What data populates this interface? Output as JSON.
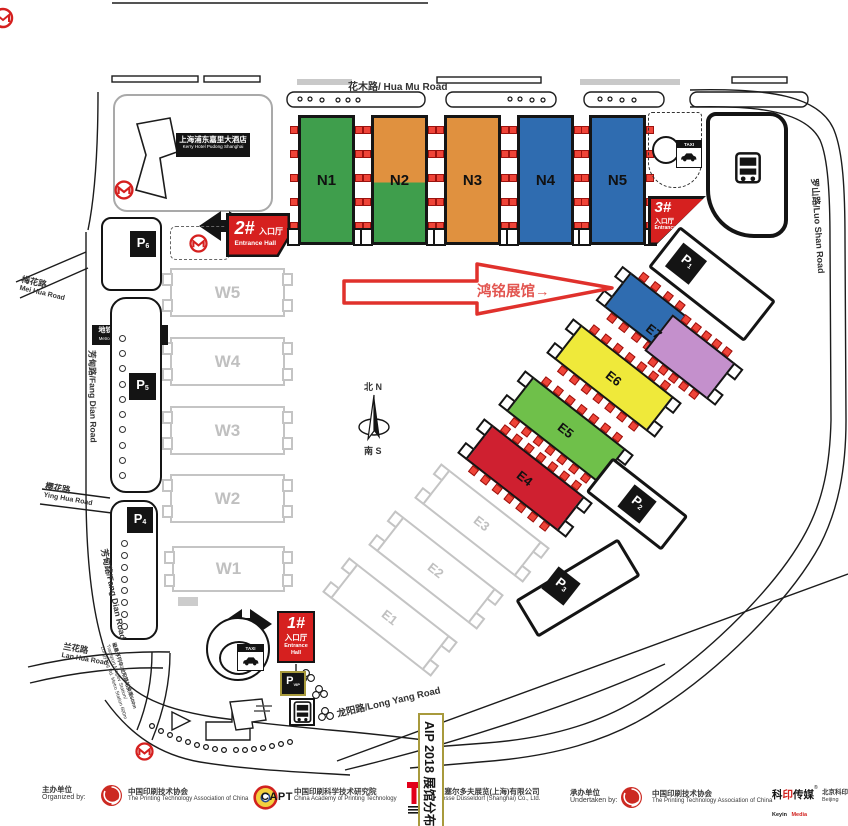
{
  "title_box": {
    "text": "AIP 2018 展馆分布图"
  },
  "annotation": {
    "text": "鸿铭展馆→"
  },
  "compass": {
    "north": "北 N",
    "south": "南 S"
  },
  "roads": {
    "hua_mu": "花木路/ Hua Mu Road",
    "luo_shan": "罗山路/Luo Shan Road",
    "mei_hua_zh": "梅花路",
    "mei_hua_en": "Mei Hua Road",
    "fang_dian": "芳甸路/Fang Dian Road",
    "ying_hua_zh": "樱花路",
    "ying_hua_en": "Ying Hua Road",
    "lan_hua_zh": "兰花路",
    "lan_hua_en": "Lan Hua Road",
    "long_yang": "龙阳路/Long Yang Road"
  },
  "landmarks": {
    "hotel_zh": "上海浦东嘉里大酒店",
    "hotel_en": "Kerry Hotel Pudong Shanghai",
    "metro_station_zh": "地铁七号线花木路站",
    "metro_station_en": "Metro Line 7 Hua Mu Rd. Station",
    "maglev_zh": "磁悬浮列车/龙阳路站换乘600m",
    "maglev_en1": "Transport Maglev Station/",
    "maglev_en2": "Longyang Rd. Metro Station 600m",
    "taxi": "TAXI"
  },
  "entrances": [
    {
      "num": "1#",
      "zh": "入口厅",
      "en": "Entrance Hall"
    },
    {
      "num": "2#",
      "zh": "入口厅",
      "en": "Entrance Hall"
    },
    {
      "num": "3#",
      "zh": "入口厅",
      "en": "Entrance Hall"
    }
  ],
  "halls": {
    "n": [
      {
        "label": "N1",
        "color": "#3f9e4c"
      },
      {
        "label": "N2",
        "color_top": "#e0913f",
        "color_bottom": "#3f9e4c"
      },
      {
        "label": "N3",
        "color": "#e0913f"
      },
      {
        "label": "N4",
        "color": "#2f6cb0"
      },
      {
        "label": "N5",
        "color": "#2f6cb0"
      }
    ],
    "w": [
      {
        "label": "W5"
      },
      {
        "label": "W4"
      },
      {
        "label": "W3"
      },
      {
        "label": "W2"
      },
      {
        "label": "W1"
      }
    ],
    "e": [
      {
        "label": "E1"
      },
      {
        "label": "E2"
      },
      {
        "label": "E3"
      },
      {
        "label": "E4",
        "color": "#cf2030"
      },
      {
        "label": "E5",
        "color": "#6fc04a"
      },
      {
        "label": "E6",
        "color": "#efe93a"
      },
      {
        "label": "E7",
        "color_a": "#2f6cb0",
        "color_b": "#c490cc"
      }
    ]
  },
  "parking": {
    "p1": {
      "label": "P",
      "sub": "1"
    },
    "p2": {
      "label": "P",
      "sub": "2"
    },
    "p3": {
      "label": "P",
      "sub": "3"
    },
    "p4": {
      "label": "P",
      "sub": "4"
    },
    "p5": {
      "label": "P",
      "sub": "5"
    },
    "p6": {
      "label": "P",
      "sub": "6"
    },
    "vip": {
      "label": "P",
      "sub": "VIP"
    }
  },
  "footer": {
    "organized_zh": "主办单位",
    "organized_en": "Organized by:",
    "org1_zh": "中国印刷技术协会",
    "org1_en": "The Printing Technology Association of China",
    "capt": "CAPT",
    "org2_zh": "中国印刷科学技术研究院",
    "org2_en": "China Academy of Printing Technology",
    "org3_zh": "杜塞尔多夫展览(上海)有限公司",
    "org3_en": "Messe Düsseldorf (Shanghai) Co., Ltd.",
    "undertaken_zh": "承办单位",
    "undertaken_en": "Undertaken by:",
    "org4_zh": "中国印刷技术协会",
    "org4_en": "The Printing Technology Association of China",
    "keyin_zh_a": "科",
    "keyin_zh_b": "印",
    "keyin_zh_c": "传媒",
    "keyin_reg": "®",
    "keyin_en_a": "Keyin",
    "keyin_en_b": "Media",
    "org5_zh": "北京科印",
    "org5_en": "Beijing"
  }
}
